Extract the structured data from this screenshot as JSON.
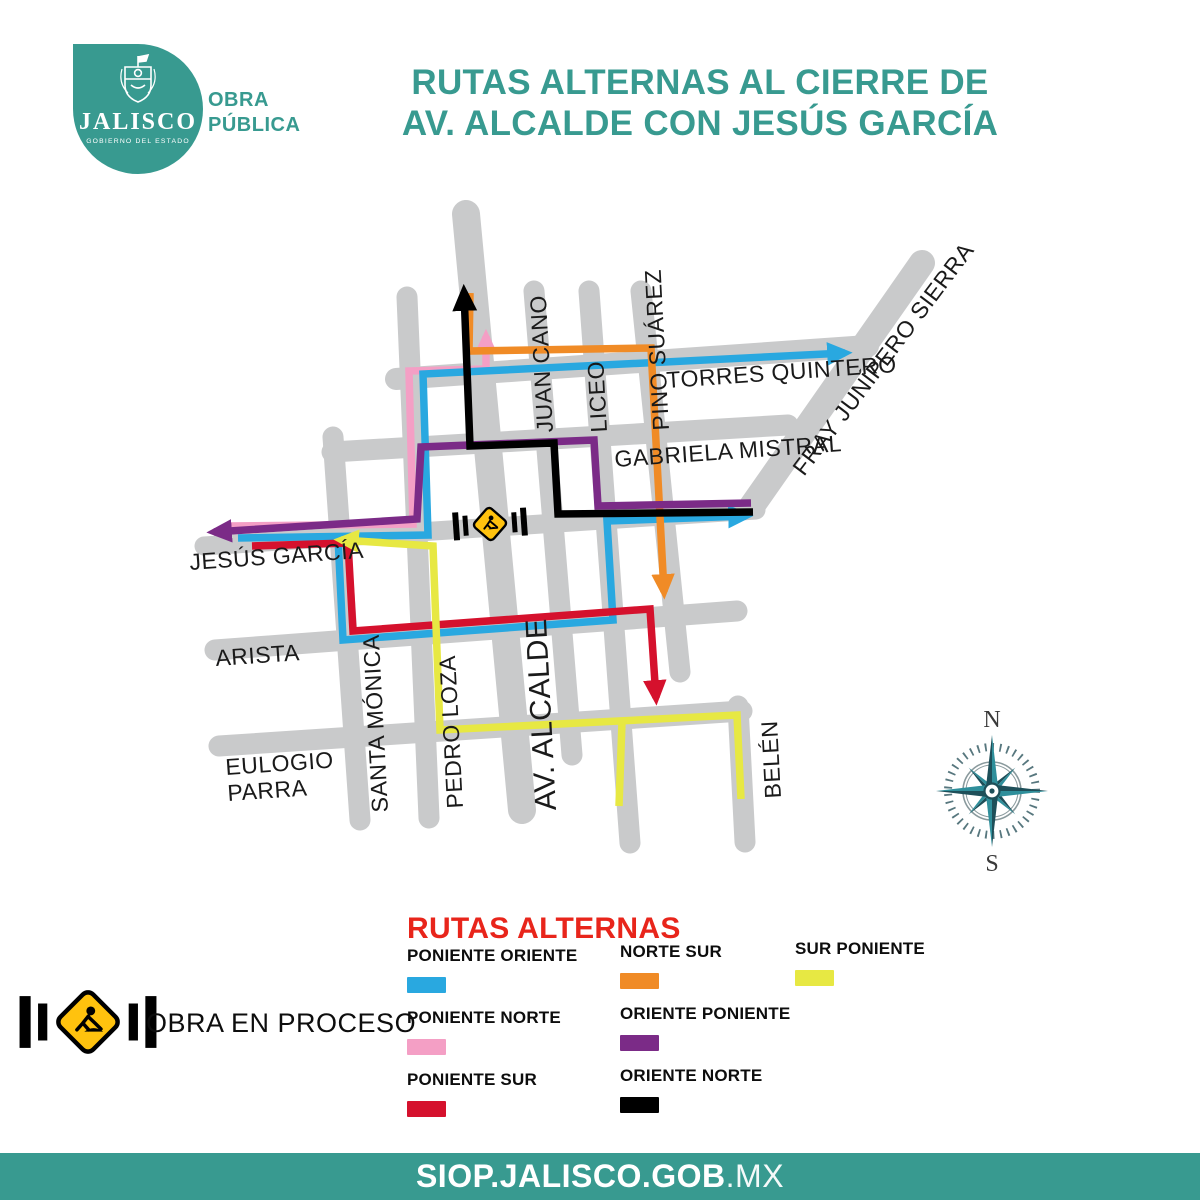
{
  "header": {
    "title_line1": "RUTAS ALTERNAS AL CIERRE DE",
    "title_line2": "AV. ALCALDE CON JESÚS GARCÍA",
    "logo": {
      "state_name": "JALISCO",
      "motto": "GOBIERNO DEL ESTADO",
      "dept_line1": "OBRA",
      "dept_line2": "PÚBLICA"
    }
  },
  "map": {
    "streets": {
      "juan_cano": "JUAN CANO",
      "liceo": "LICEO",
      "pino_suarez": "PINO SUÁREZ",
      "torres_quintero": "TORRES QUINTERO",
      "fray_junipero_sierra": "FRAY JUNÍPERO SIERRA",
      "gabriela_mistral": "GABRIELA MISTRAL",
      "jesus_garcia": "JESÚS GARCÍA",
      "arista": "ARISTA",
      "santa_monica": "SANTA MÓNICA",
      "pedro_loza": "PEDRO LOZA",
      "av_alcalde": "AV. ALCALDE",
      "eulogio_parra_line1": "EULOGIO",
      "eulogio_parra_line2": "PARRA",
      "belen": "BELÉN"
    },
    "compass": {
      "north": "N",
      "south": "S"
    }
  },
  "legend": {
    "title": "RUTAS ALTERNAS",
    "items": [
      {
        "label": "PONIENTE ORIENTE",
        "color": "#29A8E0"
      },
      {
        "label": "PONIENTE NORTE",
        "color": "#F49FC5"
      },
      {
        "label": "PONIENTE SUR",
        "color": "#D5112D"
      },
      {
        "label": "NORTE SUR",
        "color": "#F08B26"
      },
      {
        "label": "ORIENTE PONIENTE",
        "color": "#7B2B87"
      },
      {
        "label": "ORIENTE NORTE",
        "color": "#000000"
      },
      {
        "label": "SUR PONIENTE",
        "color": "#E7E843"
      }
    ],
    "obra_label": "OBRA EN PROCESO"
  },
  "footer": {
    "domain_bold": "SIOP.JALISCO.GOB",
    "domain_suffix": ".MX"
  },
  "colors": {
    "teal": "#389A90",
    "legend_title_red": "#E8251B",
    "sign_yellow": "#FFC20E",
    "street_gray": "#C9CACB"
  }
}
